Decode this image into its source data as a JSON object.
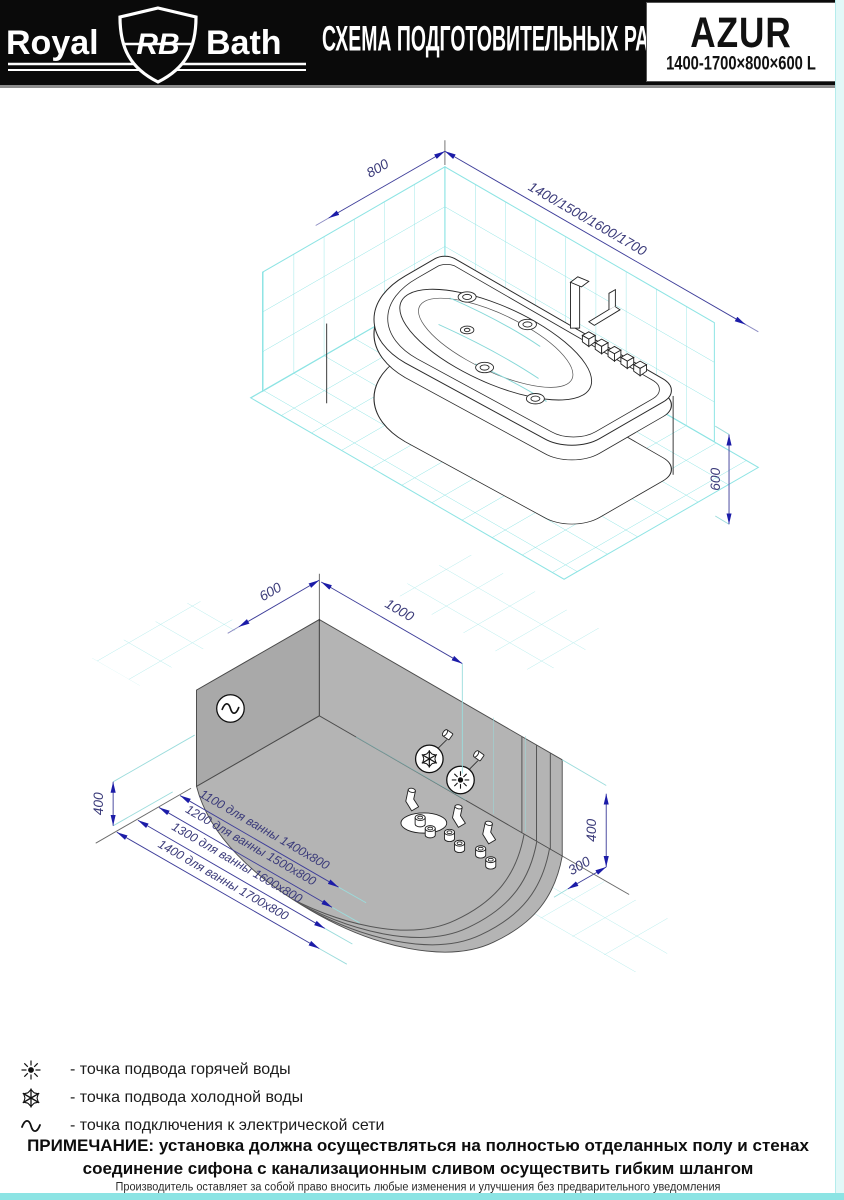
{
  "header": {
    "brand_left": "Royal",
    "logo_initials": "RB",
    "brand_right": "Bath",
    "title": "СХЕМА ПОДГОТОВИТЕЛЬНЫХ РАБОТ",
    "model": "AZUR",
    "model_size": "1400-1700×800×600 L"
  },
  "top_view": {
    "dims": {
      "width": "800",
      "lengths": "1400/1500/1600/1700",
      "height": "600"
    }
  },
  "bottom_view": {
    "dims": {
      "wall_left": "600",
      "wall_right": "1000",
      "height_left": "400",
      "height_right": "400",
      "offset": "300"
    },
    "variants": [
      "1100 для ванны 1400x800",
      "1200 для ванны 1500x800",
      "1300 для ванны 1600x800",
      "1400 для ванны 1700x800"
    ]
  },
  "legend": [
    {
      "id": "hot",
      "label": "- точка подвода горячей воды"
    },
    {
      "id": "cold",
      "label": "- точка подвода холодной воды"
    },
    {
      "id": "electric",
      "label": "- точка подключения к электрической сети"
    }
  ],
  "note": {
    "title": "ПРИМЕЧАНИЕ:",
    "line1": "установка должна осуществляться на полностью отделанных полу и стенах",
    "line2": "соединение сифона с канализационным сливом осуществить гибким шлангом"
  },
  "footer": "Производитель оставляет за собой право вносить любые изменения и улучшения без предварительного уведомления",
  "colors": {
    "accent": "#1c1ca8",
    "tile": "#8ee4e4",
    "zone_gray": "#b4b4b4"
  }
}
